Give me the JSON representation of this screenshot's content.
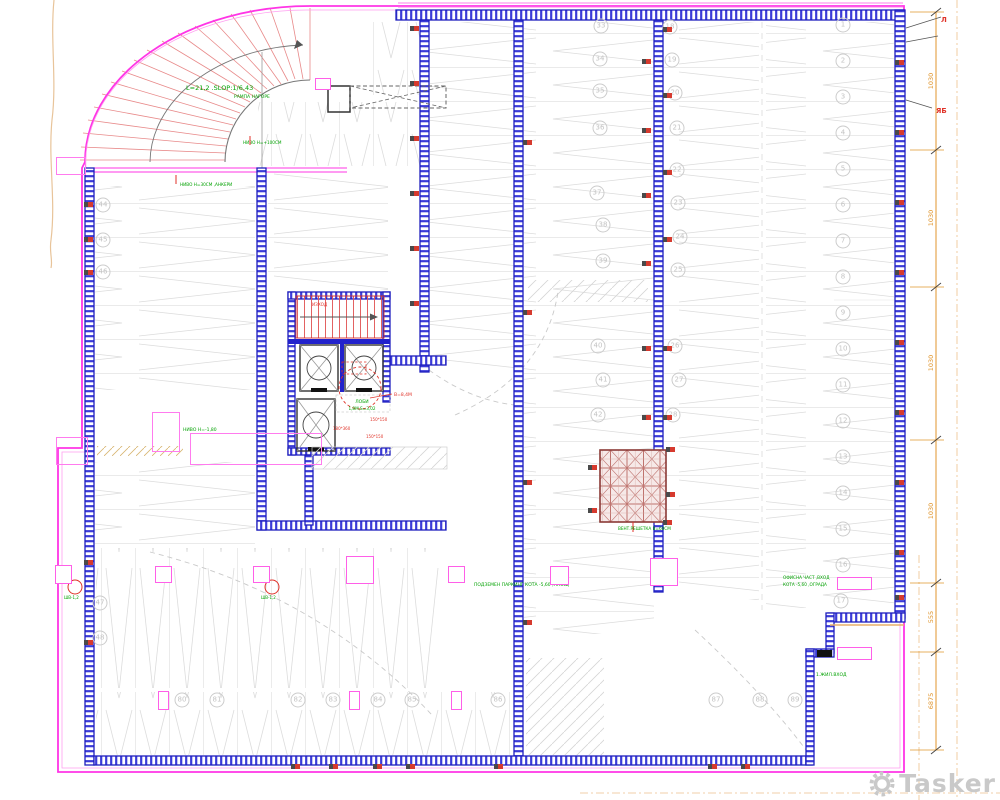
{
  "labels": {
    "ramp_line1": "L=21,2 .SLOP:1/6,43",
    "ramp_line2": "РАМПА НАГОРЕ",
    "ramp_level": "НИВО Н=+100СМ",
    "ramp_base": "НИВО Н=30СМ ,АНКЕРИ",
    "lobby_title": "ЛОБИ",
    "lobby_area": "1,8М,S=3,02",
    "lobby_note": "В=8,4М",
    "stairs_note": "ИЗХОД",
    "duct1": "150*150",
    "duct2": "180*360",
    "duct3": "150*150",
    "hall_label": "ПОДЗЕМЕН ПАРКИНГ КОТА -5,60 ,ПЛОЩ",
    "vent_label": "ВЕНТ.РЕШЕТКА В=60СМ",
    "left_label": "НИВО Н=-1,80",
    "drain1": "ШВ-1,2",
    "drain2": "ШВ-1,2",
    "office_label1": "ОФИСНА ЧАСТ ,ВХОД",
    "office_label2": "КОТА -5,60 ,ОГРАДА",
    "entry_label": "1.ЖИЛ.ВХОД",
    "leader_top": "Л",
    "leader_side": "ЯБ"
  },
  "dims": [
    "1030",
    "1030",
    "1030",
    "1030",
    "555",
    "6875"
  ],
  "watermark": {
    "text": "Tasker"
  },
  "colors": {
    "boundary": "#ff35e6",
    "wall": "#2020cc",
    "bay": "#d9d9d9",
    "annotation_green": "#00a100",
    "annotation_red": "#e03228",
    "dimension": "#e0962e",
    "watermark_gray": "#c9c9c9"
  },
  "parking_numbers": [
    {
      "n": "33",
      "x": 601,
      "y": 26
    },
    {
      "n": "34",
      "x": 600,
      "y": 59
    },
    {
      "n": "35",
      "x": 600,
      "y": 91
    },
    {
      "n": "36",
      "x": 600,
      "y": 128
    },
    {
      "n": "37",
      "x": 597,
      "y": 193
    },
    {
      "n": "38",
      "x": 603,
      "y": 225
    },
    {
      "n": "39",
      "x": 603,
      "y": 261
    },
    {
      "n": "40",
      "x": 598,
      "y": 346
    },
    {
      "n": "41",
      "x": 603,
      "y": 380
    },
    {
      "n": "42",
      "x": 598,
      "y": 415
    },
    {
      "n": "18",
      "x": 670,
      "y": 27
    },
    {
      "n": "19",
      "x": 672,
      "y": 60
    },
    {
      "n": "20",
      "x": 675,
      "y": 93
    },
    {
      "n": "21",
      "x": 677,
      "y": 128
    },
    {
      "n": "22",
      "x": 677,
      "y": 170
    },
    {
      "n": "23",
      "x": 678,
      "y": 203
    },
    {
      "n": "24",
      "x": 680,
      "y": 237
    },
    {
      "n": "25",
      "x": 678,
      "y": 270
    },
    {
      "n": "26",
      "x": 675,
      "y": 346
    },
    {
      "n": "27",
      "x": 679,
      "y": 380
    },
    {
      "n": "28",
      "x": 673,
      "y": 415
    },
    {
      "n": "1",
      "x": 843,
      "y": 25
    },
    {
      "n": "2",
      "x": 843,
      "y": 61
    },
    {
      "n": "3",
      "x": 843,
      "y": 97
    },
    {
      "n": "4",
      "x": 843,
      "y": 133
    },
    {
      "n": "5",
      "x": 843,
      "y": 169
    },
    {
      "n": "6",
      "x": 843,
      "y": 205
    },
    {
      "n": "7",
      "x": 843,
      "y": 241
    },
    {
      "n": "8",
      "x": 843,
      "y": 277
    },
    {
      "n": "9",
      "x": 843,
      "y": 313
    },
    {
      "n": "10",
      "x": 843,
      "y": 349
    },
    {
      "n": "11",
      "x": 843,
      "y": 385
    },
    {
      "n": "12",
      "x": 843,
      "y": 421
    },
    {
      "n": "13",
      "x": 843,
      "y": 457
    },
    {
      "n": "14",
      "x": 843,
      "y": 493
    },
    {
      "n": "15",
      "x": 843,
      "y": 529
    },
    {
      "n": "16",
      "x": 843,
      "y": 565
    },
    {
      "n": "17",
      "x": 841,
      "y": 601
    },
    {
      "n": "44",
      "x": 103,
      "y": 205
    },
    {
      "n": "45",
      "x": 103,
      "y": 240
    },
    {
      "n": "46",
      "x": 103,
      "y": 272
    },
    {
      "n": "47",
      "x": 100,
      "y": 603
    },
    {
      "n": "48",
      "x": 100,
      "y": 638
    },
    {
      "n": "80",
      "x": 182,
      "y": 700
    },
    {
      "n": "81",
      "x": 217,
      "y": 700
    },
    {
      "n": "82",
      "x": 298,
      "y": 700
    },
    {
      "n": "83",
      "x": 333,
      "y": 700
    },
    {
      "n": "84",
      "x": 378,
      "y": 700
    },
    {
      "n": "85",
      "x": 412,
      "y": 700
    },
    {
      "n": "86",
      "x": 498,
      "y": 700
    },
    {
      "n": "87",
      "x": 716,
      "y": 700
    },
    {
      "n": "88",
      "x": 760,
      "y": 700
    },
    {
      "n": "89",
      "x": 795,
      "y": 700
    }
  ],
  "sockets": [
    {
      "x": 414,
      "y": 26
    },
    {
      "x": 414,
      "y": 81
    },
    {
      "x": 414,
      "y": 136
    },
    {
      "x": 414,
      "y": 191
    },
    {
      "x": 414,
      "y": 246
    },
    {
      "x": 414,
      "y": 301
    },
    {
      "x": 646,
      "y": 59
    },
    {
      "x": 646,
      "y": 128
    },
    {
      "x": 646,
      "y": 193
    },
    {
      "x": 646,
      "y": 261
    },
    {
      "x": 646,
      "y": 346
    },
    {
      "x": 646,
      "y": 415
    },
    {
      "x": 667,
      "y": 27
    },
    {
      "x": 667,
      "y": 93
    },
    {
      "x": 667,
      "y": 170
    },
    {
      "x": 667,
      "y": 237
    },
    {
      "x": 667,
      "y": 346
    },
    {
      "x": 667,
      "y": 415
    },
    {
      "x": 667,
      "y": 520
    },
    {
      "x": 899,
      "y": 60
    },
    {
      "x": 899,
      "y": 130
    },
    {
      "x": 899,
      "y": 200
    },
    {
      "x": 899,
      "y": 270
    },
    {
      "x": 899,
      "y": 340
    },
    {
      "x": 899,
      "y": 410
    },
    {
      "x": 899,
      "y": 480
    },
    {
      "x": 899,
      "y": 550
    },
    {
      "x": 899,
      "y": 595
    },
    {
      "x": 295,
      "y": 764
    },
    {
      "x": 333,
      "y": 764
    },
    {
      "x": 377,
      "y": 764
    },
    {
      "x": 410,
      "y": 764
    },
    {
      "x": 498,
      "y": 764
    },
    {
      "x": 712,
      "y": 764
    },
    {
      "x": 745,
      "y": 764
    },
    {
      "x": 88,
      "y": 202
    },
    {
      "x": 88,
      "y": 237
    },
    {
      "x": 88,
      "y": 270
    },
    {
      "x": 88,
      "y": 560
    },
    {
      "x": 88,
      "y": 640
    },
    {
      "x": 592,
      "y": 465
    },
    {
      "x": 592,
      "y": 508
    },
    {
      "x": 670,
      "y": 447
    },
    {
      "x": 670,
      "y": 492
    },
    {
      "x": 527,
      "y": 140
    },
    {
      "x": 527,
      "y": 310
    },
    {
      "x": 527,
      "y": 480
    },
    {
      "x": 527,
      "y": 620
    }
  ],
  "pink_columns": [
    {
      "x": 55,
      "y": 565,
      "w": 15,
      "h": 17
    },
    {
      "x": 155,
      "y": 566,
      "w": 15,
      "h": 15
    },
    {
      "x": 253,
      "y": 566,
      "w": 15,
      "h": 15
    },
    {
      "x": 346,
      "y": 556,
      "w": 26,
      "h": 26
    },
    {
      "x": 448,
      "y": 566,
      "w": 15,
      "h": 15
    },
    {
      "x": 550,
      "y": 566,
      "w": 17,
      "h": 17
    },
    {
      "x": 650,
      "y": 558,
      "w": 26,
      "h": 26
    }
  ],
  "pink_doors": [
    {
      "x": 315,
      "y": 78,
      "w": 14,
      "h": 10
    },
    {
      "x": 158,
      "y": 691,
      "w": 9,
      "h": 17
    },
    {
      "x": 349,
      "y": 691,
      "w": 9,
      "h": 17
    },
    {
      "x": 451,
      "y": 691,
      "w": 9,
      "h": 17
    },
    {
      "x": 837,
      "y": 577,
      "w": 33,
      "h": 11
    },
    {
      "x": 837,
      "y": 647,
      "w": 33,
      "h": 11
    }
  ],
  "pink_rooms": [
    {
      "x": 190,
      "y": 433,
      "w": 130,
      "h": 30
    },
    {
      "x": 152,
      "y": 412,
      "w": 26,
      "h": 38
    },
    {
      "x": 56,
      "y": 157,
      "w": 28,
      "h": 16
    },
    {
      "x": 56,
      "y": 437,
      "w": 30,
      "h": 26
    }
  ]
}
